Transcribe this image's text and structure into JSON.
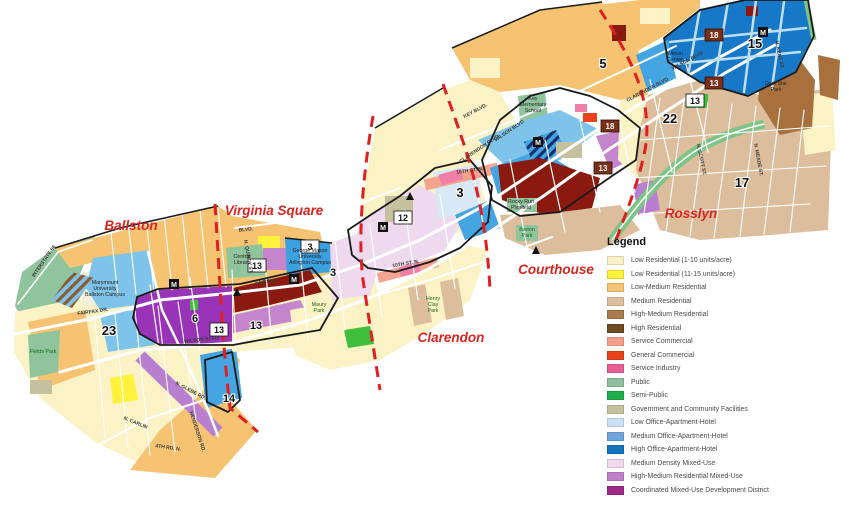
{
  "legend": {
    "title": "Legend",
    "items": [
      {
        "label": "Low Residential (1-10 units/acre)",
        "color": "#FAF0C8"
      },
      {
        "label": "Low Residential (11-15 units/acre)",
        "color": "#FFF23C"
      },
      {
        "label": "Low-Medium Residential",
        "color": "#F6C373"
      },
      {
        "label": "Medium Residential",
        "color": "#DCBE9C"
      },
      {
        "label": "High-Medium Residential",
        "color": "#A87C4F"
      },
      {
        "label": "High Residential",
        "color": "#6F4A22"
      },
      {
        "label": "Service Commercial",
        "color": "#F49E8C"
      },
      {
        "label": "General Commercial",
        "color": "#E8431C"
      },
      {
        "label": "Service Industry",
        "color": "#E75E93"
      },
      {
        "label": "Public",
        "color": "#8FBF9C"
      },
      {
        "label": "Semi-Public",
        "color": "#1FAE4C"
      },
      {
        "label": "Government and Community Facilities",
        "color": "#C5C09E"
      },
      {
        "label": "Low Office-Apartment-Hotel",
        "color": "#CCE0F5"
      },
      {
        "label": "Medium Office-Apartment-Hotel",
        "color": "#6FA4DC"
      },
      {
        "label": "High Office-Apartment-Hotel",
        "color": "#1572BC"
      },
      {
        "label": "Medium Density Mixed-Use",
        "color": "#F0D8EE"
      },
      {
        "label": "High-Medium Residential Mixed-Use",
        "color": "#C080C8"
      },
      {
        "label": "Coordinated Mixed-Use Development District",
        "color": "#A02888"
      }
    ]
  },
  "map": {
    "areas": {
      "ballston": "Ballston",
      "virginia_square": "Virginia Square",
      "clarendon": "Clarendon",
      "courthouse": "Courthouse",
      "rosslyn": "Rosslyn"
    },
    "badges": [
      {
        "text": "23"
      },
      {
        "text": "6"
      },
      {
        "text": "13"
      },
      {
        "text": "13"
      },
      {
        "text": "13"
      },
      {
        "text": "3"
      },
      {
        "text": "3"
      },
      {
        "text": "12"
      },
      {
        "text": "3"
      },
      {
        "text": "14"
      },
      {
        "text": "5"
      },
      {
        "text": "18"
      },
      {
        "text": "13"
      },
      {
        "text": "18"
      },
      {
        "text": "13"
      },
      {
        "text": "13"
      },
      {
        "text": "15"
      },
      {
        "text": "22"
      },
      {
        "text": "17"
      }
    ],
    "metro": {
      "symbol": "M"
    },
    "places": {
      "marymount_1": "Marymount",
      "marymount_2": "University",
      "marymount_3": "Ballston Campus",
      "fields_park": "Fields Park",
      "central_library_1": "Central",
      "central_library_2": "Library",
      "gmu_1": "George Mason",
      "gmu_2": "University",
      "gmu_3": "Arlington Campus",
      "maury_park_1": "Maury",
      "maury_park_2": "Park",
      "henry_clay_1": "Henry",
      "henry_clay_2": "Clay",
      "henry_clay_3": "Park",
      "key_school_1": "Key",
      "key_school_2": "Elementary",
      "key_school_3": "School",
      "rocky_run_1": "Rocky Run",
      "rocky_run_2": "Playfield",
      "barton_park_1": "Barton",
      "barton_park_2": "Park",
      "wilson_center_1": "Wilson",
      "wilson_center_2": "Center",
      "dark_star_1": "Dark Star",
      "dark_star_2": "Park"
    },
    "streets": {
      "interstate_66": "INTERSTATE 66",
      "fairfax_dr_w": "FAIRFAX DR.",
      "fairfax_dr_e": "FAIRFAX",
      "wilson_blvd_ballston": "WILSON BLVD.",
      "wilson_blvd_courthouse": "WILSON BLVD",
      "wilson_blvd_rosslyn": "WILSON BLVD",
      "clarendon_blvd_courthouse": "CLARENDON BLVD",
      "clarendon_blvd_rosslyn": "CLARENDON BLVD",
      "key_blvd": "KEY BLVD.",
      "washington_blvd": "BLVD.",
      "tenth_st_clarendon": "10TH ST. N.",
      "tenth_st_courthouse": "10TH ST. N.",
      "n_glebe_rd": "N. GLEBE RD.",
      "n_carlin": "N. CARLIN",
      "fourth_rd_n": "4TH RD. N.",
      "henderson_rd": "HENDERSON RD.",
      "n_quincy_st": "N. QUINCY ST.",
      "n_kent_st": "N. KENT ST.",
      "n_meade_st": "N. MEADE ST.",
      "n_scott_st": "N. SCOTT ST."
    },
    "colors": {
      "area_label": "#D9251D",
      "station_boundary_dash": "#E02020",
      "district_outline": "#1A1A1A"
    }
  }
}
